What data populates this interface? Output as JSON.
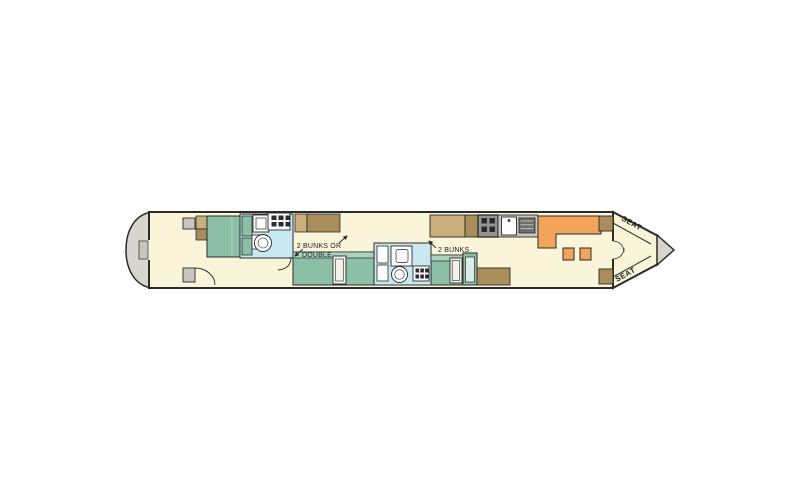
{
  "labels": {
    "cabin_mid_line1": "2 BUNKS OR",
    "cabin_mid_line2": "DOUBLE",
    "cabin_aft": "2 BUNKS",
    "seat_top": "SEAT",
    "seat_bottom": "SEAT"
  },
  "colors": {
    "cream": "#FAF5D8",
    "teal": "#8BBFA6",
    "tealLight": "#A9D3BE",
    "tealPanel": "#D9EEE7",
    "bath": "#C8E9F1",
    "tanLight": "#C9AD7B",
    "tanDark": "#A98D5B",
    "orange": "#F1A45A",
    "gray": "#C7C6BF",
    "grayDark": "#95958F",
    "drainer": "#6F6F6A",
    "hullGray": "#D6D5CE",
    "doorWhite": "#F2F1EA",
    "line": "#2B2B2B",
    "white": "#FFFFFF"
  }
}
